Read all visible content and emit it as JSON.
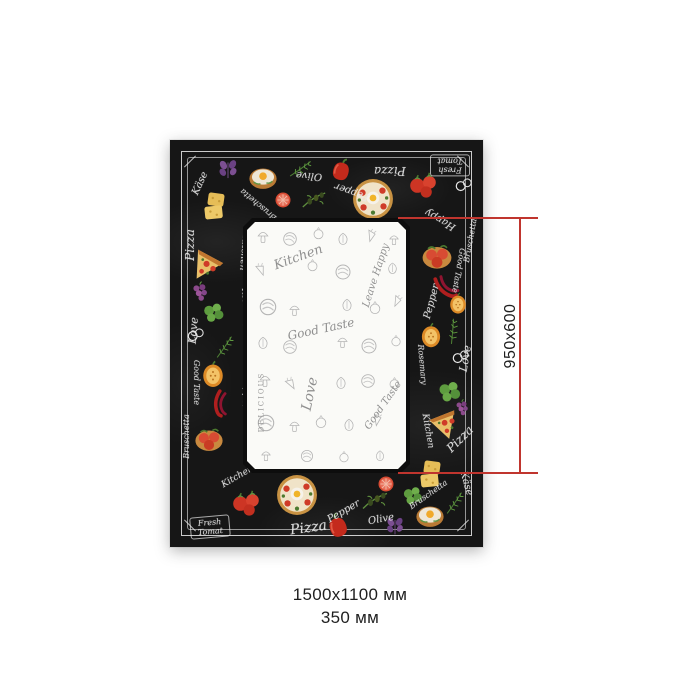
{
  "measure": {
    "inner_label": "950x600",
    "overall_size": "1500х1100 мм",
    "hem_size": "350 мм",
    "line_color": "#c0352e",
    "text_color": "#1f1f1f"
  },
  "towel": {
    "colors": {
      "board": "#161616",
      "chalk": "#e9e9e9",
      "frame": "#e6e6e6",
      "panel_bg": "#fafaf7",
      "sketch_gray": "#b5b5b5",
      "tomato_red": "#cd3524",
      "pepper_red": "#c42a1c",
      "cheese_yellow": "#e6bd57",
      "greens": "#5e9c3f",
      "orange_pepper": "#dd8a26"
    },
    "border_labels": [
      {
        "text": "Käse"
      },
      {
        "text": "Bruschetta"
      },
      {
        "text": "Olive"
      },
      {
        "text": "Pepper"
      },
      {
        "text": "Pizza"
      },
      {
        "text": "Fresh Tomat"
      },
      {
        "text": "Happy"
      },
      {
        "text": "Bruschetta"
      },
      {
        "text": "Good Taste"
      },
      {
        "text": "Pepper"
      },
      {
        "text": "Love"
      },
      {
        "text": "Rosemary"
      },
      {
        "text": "Kitchen"
      },
      {
        "text": "Pizza"
      },
      {
        "text": "Käse"
      },
      {
        "text": "Bruschetta"
      },
      {
        "text": "Olive"
      },
      {
        "text": "Pepper"
      },
      {
        "text": "Pizza"
      },
      {
        "text": "Kitchen"
      },
      {
        "text": "Fresh Tomat"
      },
      {
        "text": "Love"
      },
      {
        "text": "Good Taste"
      },
      {
        "text": "Rosemary"
      },
      {
        "text": "Pepper"
      },
      {
        "text": "Pizza"
      },
      {
        "text": "Kitchen"
      },
      {
        "text": "Bruschetta"
      }
    ],
    "panel_words": [
      {
        "text": "Kitchen"
      },
      {
        "text": "Leave Happy"
      },
      {
        "text": "Good Taste"
      },
      {
        "text": "Love"
      },
      {
        "text": "DELICIOUS"
      },
      {
        "text": "Good Taste"
      }
    ],
    "icons": [
      "pizza-icon",
      "pizza-slice-icon",
      "tomato-cluster-icon",
      "tomato-slice-icon",
      "bell-pepper-icon",
      "pepper-half-icon",
      "chili-icon",
      "cheese-icon",
      "egg-toast-icon",
      "tomato-toast-icon",
      "olive-branch-icon",
      "greens-icon",
      "rosemary-icon",
      "pretzel-rings-icon",
      "grapes-icon",
      "basil-icon"
    ]
  }
}
